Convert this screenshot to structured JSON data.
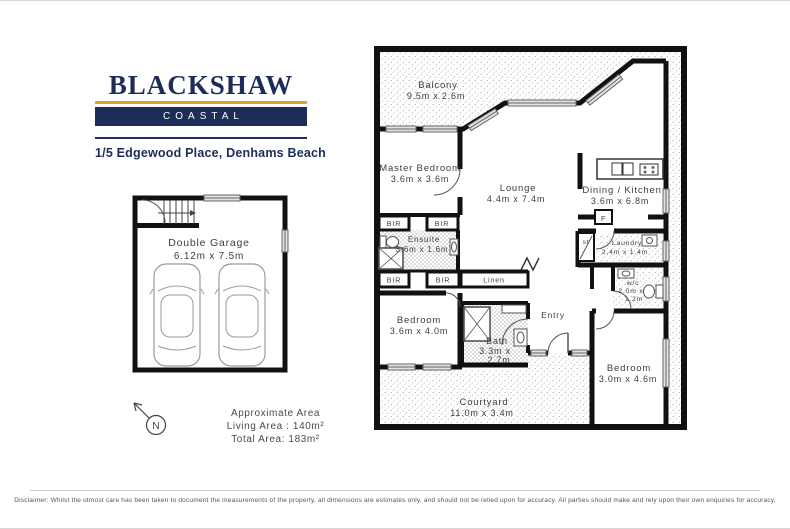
{
  "brand": {
    "name": "BLACKSHAW",
    "division": "COASTAL",
    "address": "1/5 Edgewood Place, Denhams Beach"
  },
  "colors": {
    "navy": "#1d2c59",
    "gold": "#d7a43c",
    "wall": "#111111"
  },
  "plan": {
    "garage": {
      "name": "Double Garage",
      "dims": "6.12m x 7.5m"
    },
    "balcony": {
      "name": "Balcony",
      "dims": "9.5m x 2.6m"
    },
    "master_bedroom": {
      "name": "Master Bedroom",
      "dims": "3.6m x 3.6m"
    },
    "lounge": {
      "name": "Lounge",
      "dims": "4.4m x 7.4m"
    },
    "dining_kitchen": {
      "name": "Dining / Kitchen",
      "dims": "3.6m x 6.8m"
    },
    "ensuite": {
      "name": "Ensuite",
      "dims": "3.6m x 1.6m"
    },
    "laundry": {
      "name": "Laundry",
      "dims": "2.4m x 1.4m"
    },
    "wc": {
      "name": "w/c",
      "dims_line1": "2.0m x",
      "dims_line2": "1.2m"
    },
    "bedroom_mid": {
      "name": "Bedroom",
      "dims": "3.6m x 4.0m"
    },
    "bath": {
      "name": "Bath",
      "dims_line1": "3.3m x",
      "dims_line2": "2.7m"
    },
    "bedroom_right": {
      "name": "Bedroom",
      "dims": "3.0m x 4.6m"
    },
    "courtyard": {
      "name": "Courtyard",
      "dims": "11.0m x 3.4m"
    },
    "entry_label": "Entry",
    "linen_label": "Linen",
    "bir_label": "BIR",
    "storage_label": "st",
    "fridge_label": "F",
    "compass_label": "N"
  },
  "area_summary": {
    "line1": "Approximate Area",
    "line2": "Living Area : 140m²",
    "line3": "Total Area: 183m²"
  },
  "footer": {
    "disclaimer": "Disclaimer: Whilst the utmost care has been taken to document the measurements of the property, all dimensions are estimates only, and should not be relied upon for accuracy. All parties should make and rely upon their own enquiries for accuracy."
  }
}
